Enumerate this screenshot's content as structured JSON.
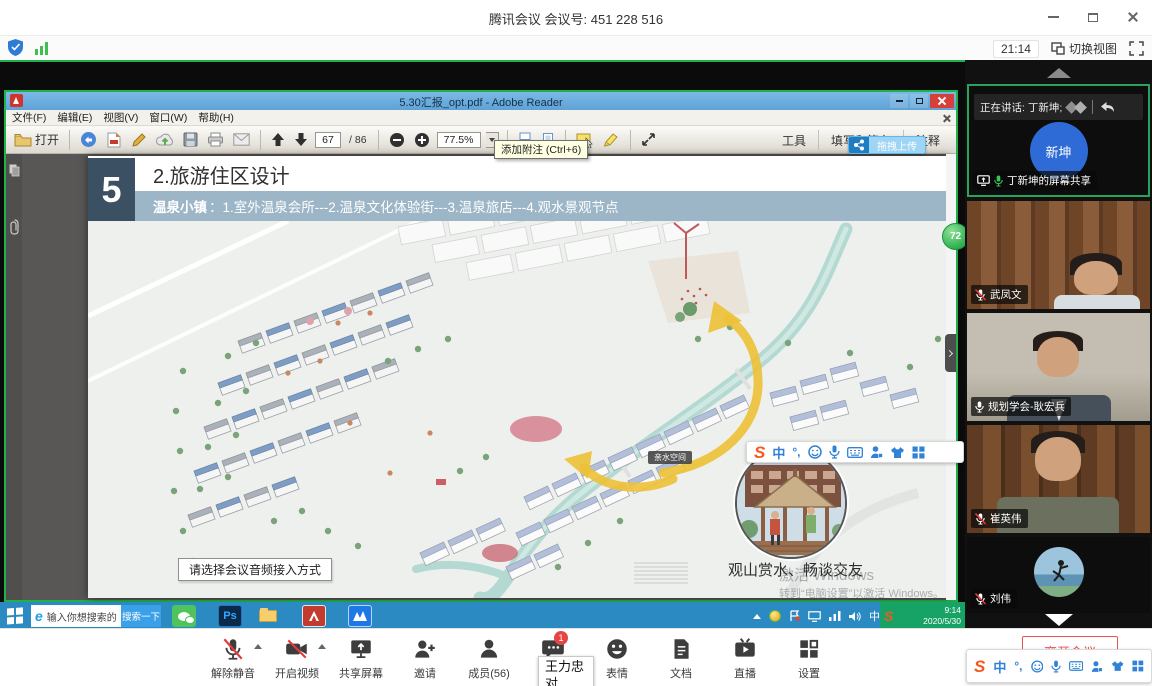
{
  "window": {
    "title": "腾讯会议 会议号: 451 228 516"
  },
  "statusbar": {
    "time": "21:14",
    "switch_view": "切换视图"
  },
  "reader": {
    "title": "5.30汇报_opt.pdf - Adobe Reader",
    "menus": [
      {
        "label": "文件(F)"
      },
      {
        "label": "编辑(E)"
      },
      {
        "label": "视图(V)"
      },
      {
        "label": "窗口(W)"
      },
      {
        "label": "帮助(H)"
      }
    ],
    "open_label": "打开",
    "page_current": "67",
    "page_total": "/ 86",
    "zoom_level": "77.5%",
    "tooltip": "添加附注 (Ctrl+6)",
    "tools_label": "工具",
    "fill_sign_label": "填写和签名",
    "comment_label": "注释",
    "upload_badge": "拖拽上传",
    "speedball": "72"
  },
  "pdf": {
    "section_number": "5",
    "title": "2.旅游住区设计",
    "subtitle_lead": "温泉小镇",
    "subtitle_rest": "：1.室外温泉会所---2.温泉文化体验街---3.温泉旅店---4.观水景观节点",
    "inset_label": "亲水空间",
    "inset_caption": "观山赏水、畅谈交友",
    "watermark_line1": "激活 Windows",
    "watermark_line2": "转到“电脑设置”以激活 Windows。",
    "audio_tooltip": "请选择会议音频接入方式"
  },
  "chat_bubble": {
    "name": "王力忠",
    "message": "对"
  },
  "taskbar": {
    "browser_letter": "e",
    "search_placeholder": "输入你想搜索的",
    "search_button": "搜索一下",
    "ps_label": "Ps",
    "ime_mode": "中",
    "time": "9:14",
    "date": "2020/5/30"
  },
  "sogou": {
    "letter": "S",
    "mode": "中",
    "punct": "°,"
  },
  "sidebar": {
    "speaking_label": "正在讲话: 丁新坤;",
    "tiles": [
      {
        "name": "丁新坤的屏幕共享",
        "avatar_text": "新坤"
      },
      {
        "name": "武凤文"
      },
      {
        "name": "规划学会-耿宏兵"
      },
      {
        "name": "崔英伟"
      },
      {
        "name": "刘伟"
      }
    ]
  },
  "controls": [
    {
      "label": "解除静音"
    },
    {
      "label": "开启视频"
    },
    {
      "label": "共享屏幕"
    },
    {
      "label": "邀请"
    },
    {
      "label": "成员(56)"
    },
    {
      "label": "聊天",
      "badge": "1"
    },
    {
      "label": "表情"
    },
    {
      "label": "文档"
    },
    {
      "label": "直播"
    },
    {
      "label": "设置"
    }
  ],
  "leave_label": "离开会议",
  "colors": {
    "share_green": "#1fb14c",
    "reader_titlebar_blue": "#6fb0e0",
    "taskbar_blue": "#2b8ac2",
    "leave_red": "#e85454",
    "subtitle_bar": "#9cb6c7",
    "header_box": "#3c5064",
    "route_arrow_yellow": "#edc13a",
    "river_teal": "#b3d9d2"
  }
}
